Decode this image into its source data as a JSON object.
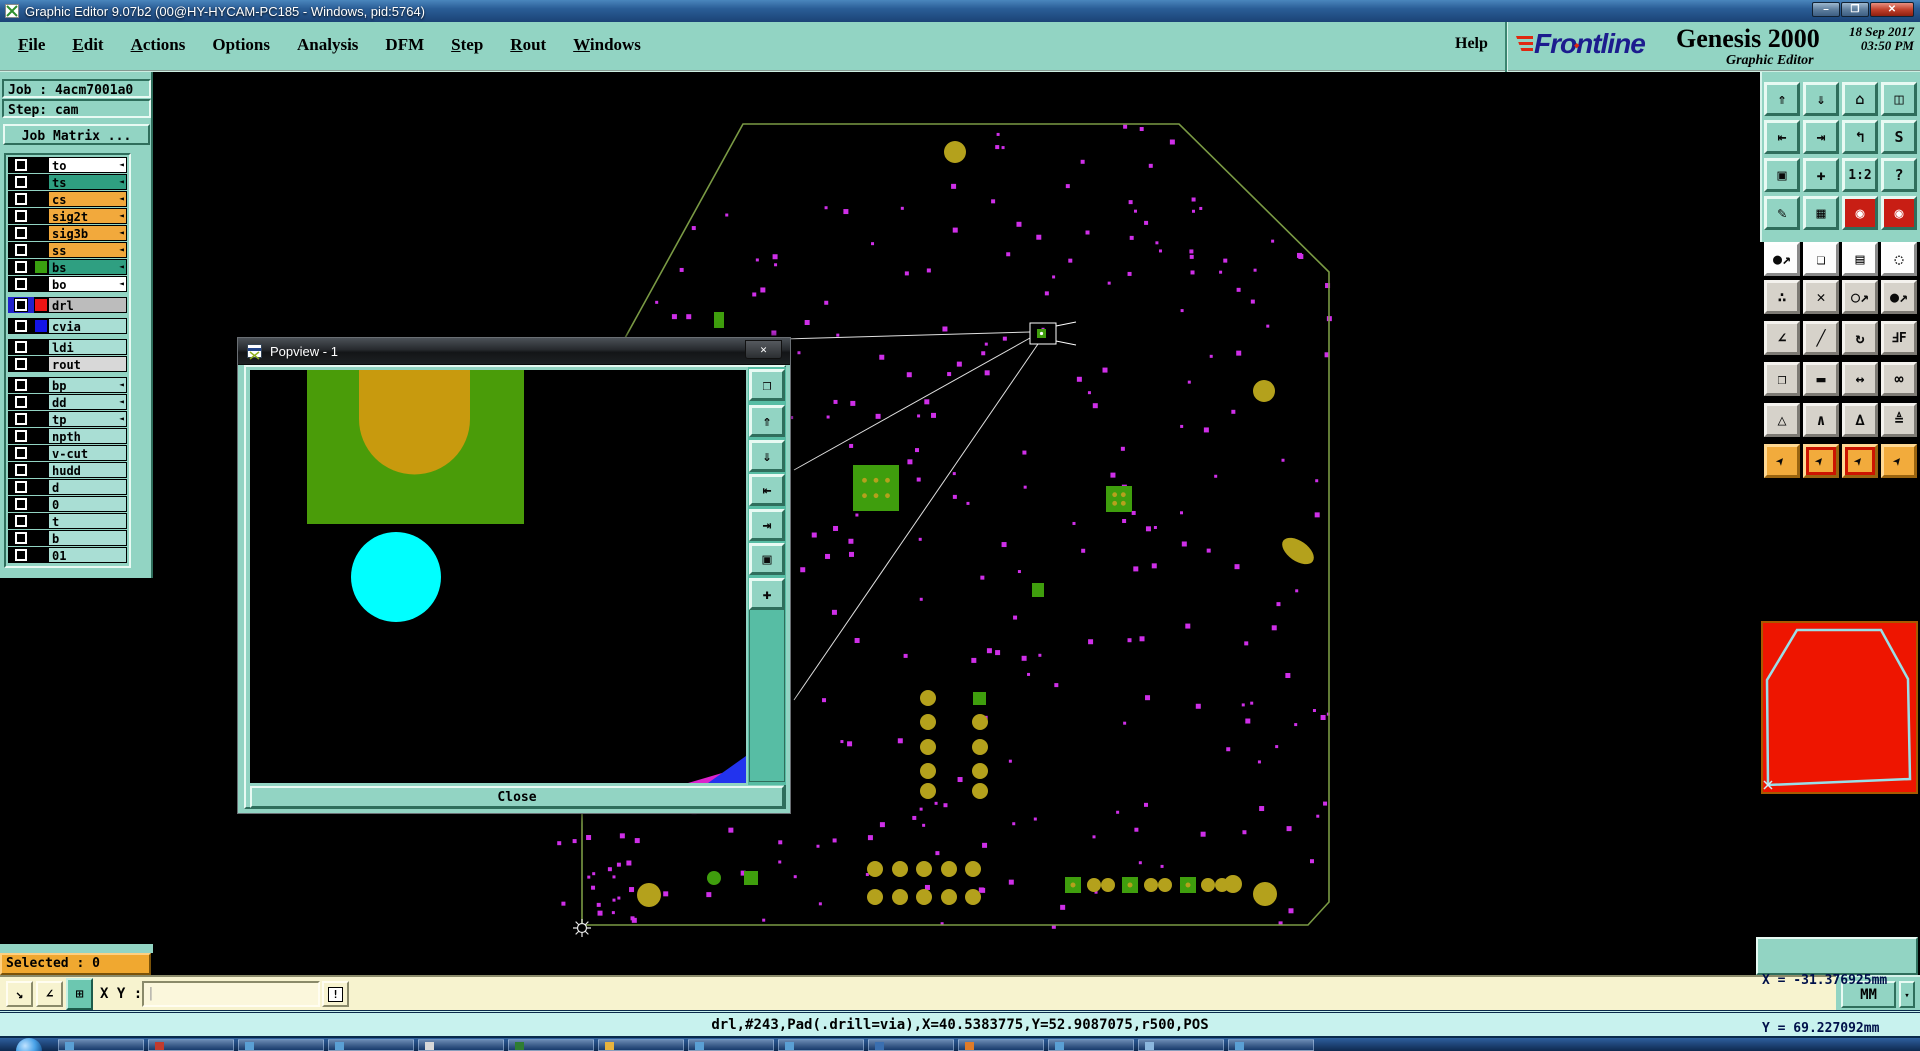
{
  "window": {
    "title": "Graphic Editor 9.07b2 (00@HY-HYCAM-PC185 - Windows, pid:5764)",
    "minimize": "–",
    "restore": "❐",
    "close": "✕"
  },
  "menu": {
    "items": [
      {
        "label": "File",
        "u": 0
      },
      {
        "label": "Edit",
        "u": 0
      },
      {
        "label": "Actions",
        "u": 0
      },
      {
        "label": "Options"
      },
      {
        "label": "Analysis"
      },
      {
        "label": "DFM"
      },
      {
        "label": "Step",
        "u": 0
      },
      {
        "label": "Rout",
        "u": 0
      },
      {
        "label": "Windows",
        "u": 0
      }
    ],
    "help": "Help"
  },
  "brand": {
    "logo": "Frontline",
    "product": "Genesis 2000",
    "date": "18 Sep 2017",
    "time": "03:50 PM",
    "subtitle": "Graphic Editor"
  },
  "sidebar": {
    "job": "Job : 4acm7001a0",
    "step": "Step: cam",
    "matrix": "Job Matrix ...",
    "arrow_glyph": "◄",
    "layers": [
      {
        "name": "to",
        "bg": "#ffffff",
        "arrow": true
      },
      {
        "name": "ts",
        "bg": "#2f9f81",
        "arrow": true
      },
      {
        "name": "cs",
        "bg": "#f2a93c",
        "arrow": true
      },
      {
        "name": "sig2t",
        "bg": "#f2a93c",
        "arrow": true
      },
      {
        "name": "sig3b",
        "bg": "#f2a93c",
        "arrow": true
      },
      {
        "name": "ss",
        "bg": "#f2a93c",
        "arrow": true
      },
      {
        "name": "bs",
        "bg": "#2f9f81",
        "chip": "#3aa010",
        "arrow": true
      },
      {
        "name": "bo",
        "bg": "#ffffff",
        "arrow": true
      },
      {
        "name": "drl",
        "bg": "#bcbcbc",
        "chip": "#ee1414",
        "box": "#2222cc",
        "gap": true
      },
      {
        "name": "cvia",
        "bg": "#a9ded4",
        "chip": "#1414e6",
        "gap": true
      },
      {
        "name": "ldi",
        "bg": "#a9ded4",
        "gap": true
      },
      {
        "name": "rout",
        "bg": "#d8d8d8"
      },
      {
        "name": "bp",
        "bg": "#a9ded4",
        "arrow": true,
        "gap": true
      },
      {
        "name": "dd",
        "bg": "#a9ded4",
        "arrow": true
      },
      {
        "name": "tp",
        "bg": "#a9ded4",
        "arrow": true
      },
      {
        "name": "npth",
        "bg": "#a9ded4"
      },
      {
        "name": "v-cut",
        "bg": "#a9ded4"
      },
      {
        "name": "hudd",
        "bg": "#a9ded4"
      },
      {
        "name": "d",
        "bg": "#a9ded4"
      },
      {
        "name": "0",
        "bg": "#a9ded4"
      },
      {
        "name": "t",
        "bg": "#a9ded4"
      },
      {
        "name": "b",
        "bg": "#a9ded4"
      },
      {
        "name": "01",
        "bg": "#a9ded4"
      }
    ]
  },
  "popview": {
    "title": "Popview - 1",
    "close_x": "✕",
    "close": "Close",
    "tools": [
      {
        "n": "popout-window",
        "g": "❐"
      },
      {
        "n": "push-up",
        "g": "⇑"
      },
      {
        "n": "push-down",
        "g": "⇓"
      },
      {
        "n": "shift-left",
        "g": "⇤"
      },
      {
        "n": "shift-right",
        "g": "⇥"
      },
      {
        "n": "zoom-contract",
        "g": "▣"
      },
      {
        "n": "pan-expand",
        "g": "✚"
      }
    ],
    "canvas": {
      "green_rect": [
        57,
        0,
        217,
        154
      ],
      "orange_u": [
        109,
        0,
        111,
        49,
        55.5
      ],
      "cyan_circle": [
        146,
        207,
        45
      ],
      "wedge_magenta": [
        [
          496,
          396
        ],
        [
          496,
          413
        ],
        [
          438,
          413
        ]
      ],
      "wedge_blue": [
        [
          496,
          386
        ],
        [
          496,
          413
        ],
        [
          458,
          413
        ]
      ],
      "colors": {
        "green": "#4a9c09",
        "orange": "#c89a0e",
        "cyan": "#00ffff",
        "blue": "#2233ee",
        "magenta": "#dd22cc"
      }
    }
  },
  "toolbar": {
    "row_bg": [
      "teal",
      "teal",
      "teal",
      "teal",
      "white",
      "gray",
      "gray",
      "gray",
      "gray",
      "orange"
    ],
    "rows": [
      [
        {
          "n": "zoom-in",
          "g": "⇑"
        },
        {
          "n": "zoom-out",
          "g": "⇓"
        },
        {
          "n": "home-view",
          "g": "⌂"
        },
        {
          "n": "xy-window",
          "g": "◫"
        }
      ],
      [
        {
          "n": "pan-left",
          "g": "⇤"
        },
        {
          "n": "pan-right",
          "g": "⇥"
        },
        {
          "n": "undo-view",
          "g": "↰"
        },
        {
          "n": "serpentine",
          "g": "S"
        }
      ],
      [
        {
          "n": "zoom-fit",
          "g": "▣"
        },
        {
          "n": "pan-center",
          "g": "✚"
        },
        {
          "n": "scale-1-2",
          "g": "1:2"
        },
        {
          "n": "query",
          "g": "?"
        }
      ],
      [
        {
          "n": "draw-tools",
          "g": "✎"
        },
        {
          "n": "grid-toggle",
          "g": "▦"
        },
        {
          "n": "highlight-net",
          "g": "◉",
          "bg": "#c81e14",
          "fg": "#ffffff"
        },
        {
          "n": "highlight-net-2",
          "g": "◉",
          "bg": "#c81e14",
          "fg": "#ffffff"
        }
      ],
      [
        {
          "n": "move-feature",
          "g": "●↗"
        },
        {
          "n": "copy-feature",
          "g": "❏"
        },
        {
          "n": "measure-ruler",
          "g": "▤"
        },
        {
          "n": "clip-area",
          "g": "◌"
        }
      ],
      [
        {
          "n": "chain-select",
          "g": "∴"
        },
        {
          "n": "delete-feature",
          "g": "✕"
        },
        {
          "n": "open-endpoint",
          "g": "○↗"
        },
        {
          "n": "filled-endpoint",
          "g": "●↗"
        }
      ],
      [
        {
          "n": "angle-measure",
          "g": "∠"
        },
        {
          "n": "line-draw",
          "g": "╱"
        },
        {
          "n": "rotate",
          "g": "↻"
        },
        {
          "n": "mirror-text",
          "g": "ℲF"
        }
      ],
      [
        {
          "n": "swap-pads",
          "g": "❐"
        },
        {
          "n": "line-segment",
          "g": "▬"
        },
        {
          "n": "width-measure",
          "g": "↔"
        },
        {
          "n": "touch-circles",
          "g": "∞"
        }
      ],
      [
        {
          "n": "triangle-mark",
          "g": "△"
        },
        {
          "n": "peak-mark",
          "g": "∧"
        },
        {
          "n": "peak-line",
          "g": "∆"
        },
        {
          "n": "peak-measure",
          "g": "≜"
        }
      ],
      [
        {
          "n": "select-arrow",
          "g": "➤",
          "rot": -50
        },
        {
          "n": "select-frame",
          "g": "➤",
          "rot": -50,
          "frame": "#cc1400"
        },
        {
          "n": "select-region",
          "g": "➤",
          "rot": -50,
          "frame": "#cc1400"
        },
        {
          "n": "select-path",
          "g": "➤",
          "rot": -50
        }
      ]
    ]
  },
  "preview": {
    "bg": "#ee1500",
    "outline": [
      [
        5,
        162
      ],
      [
        4,
        57
      ],
      [
        34,
        7
      ],
      [
        118,
        7
      ],
      [
        145,
        56
      ],
      [
        147,
        156
      ]
    ],
    "outline_color": "#9adfe8"
  },
  "readout": {
    "x": "X = -31.376925mm",
    "y": "Y = 69.227092mm"
  },
  "units": {
    "label": "MM"
  },
  "statusbar": {
    "selected": "Selected : 0",
    "xy_label": "X Y :",
    "xy_value": "",
    "caret": "|",
    "alert": "!",
    "line1": "<M1> - Select feature to highlight ; <M1><M1> - Highlight identical",
    "line2": "<Shift+M1> - Add to highlight ; <M2> - Cancel highlight",
    "tools": [
      {
        "n": "drag-resize",
        "g": "↘"
      },
      {
        "n": "snap-angle",
        "g": "∠"
      },
      {
        "n": "grid-window",
        "g": "⊞",
        "active": true
      }
    ]
  },
  "infobar": {
    "text": "drl,#243,Pad(.drill=via),X=40.5383775,Y=52.9087075,r500,POS"
  },
  "canvas": {
    "outline": [
      [
        743,
        124
      ],
      [
        1179,
        124
      ],
      [
        1329,
        272
      ],
      [
        1329,
        902
      ],
      [
        1308,
        925
      ],
      [
        582,
        925
      ],
      [
        582,
        416
      ]
    ],
    "outline_color": "#7a9a44",
    "dot_color": "#cf2fe8",
    "dot_seed": 9,
    "dot_count": 280,
    "extra_dot_region": {
      "x": 556,
      "y": 780,
      "w": 92,
      "h": 150,
      "count": 20
    },
    "olive": "#b4a11c",
    "green": "#3f9e0d",
    "olive_circles": [
      [
        955,
        152,
        11
      ],
      [
        1264,
        391,
        11
      ],
      [
        649,
        895,
        12
      ],
      [
        1265,
        894,
        12
      ],
      [
        1233,
        884,
        9
      ]
    ],
    "olive_blob": [
      1298,
      551,
      18,
      10,
      35
    ],
    "green_pads": [
      [
        853,
        465,
        46,
        46
      ],
      [
        1106,
        486,
        26,
        26
      ]
    ],
    "small_green_rects": [
      [
        714,
        312,
        10,
        16
      ],
      [
        1032,
        583,
        12,
        14
      ],
      [
        973,
        692,
        13,
        13
      ],
      [
        744,
        871,
        14,
        14
      ]
    ],
    "green_circles": [
      [
        714,
        878,
        7
      ]
    ],
    "col_block": {
      "xs": [
        928,
        980
      ],
      "ys": [
        698,
        722,
        747,
        771,
        791
      ],
      "r": 8,
      "skip_first_right": true
    },
    "row_block": {
      "xs": [
        875,
        900,
        924,
        949,
        973
      ],
      "ys": [
        869,
        897
      ],
      "r": 8
    },
    "bottom_squares": [
      [
        1065,
        877,
        16
      ],
      [
        1122,
        877,
        16
      ],
      [
        1180,
        877,
        16
      ]
    ],
    "bottom_circles": [
      [
        1094,
        885
      ],
      [
        1108,
        885
      ],
      [
        1151,
        885
      ],
      [
        1165,
        885
      ],
      [
        1208,
        885
      ],
      [
        1222,
        885
      ]
    ],
    "bottom_circle_r": 7,
    "highlight_box": [
      1030,
      323,
      26,
      21
    ],
    "highlight_sq": [
      1037,
      329,
      9,
      9
    ],
    "callouts": [
      [
        611,
        344,
        1030,
        332
      ],
      [
        794,
        470,
        1030,
        338
      ],
      [
        794,
        700,
        1038,
        344
      ]
    ],
    "callout_color": "#e0e0e0",
    "compass": [
      582,
      928
    ]
  },
  "taskbar": {
    "buttons": [
      "#5a9fd4",
      "#c23b2e",
      "#5a9fd4",
      "#5a9fd4",
      "#d8d8d8",
      "#2f7d32",
      "#e8b33d",
      "#5a9fd4",
      "#5a9fd4",
      "#3a6fb0",
      "#e07b28",
      "#5a9fd4",
      "#8bb7de",
      "#5a9fd4"
    ]
  }
}
